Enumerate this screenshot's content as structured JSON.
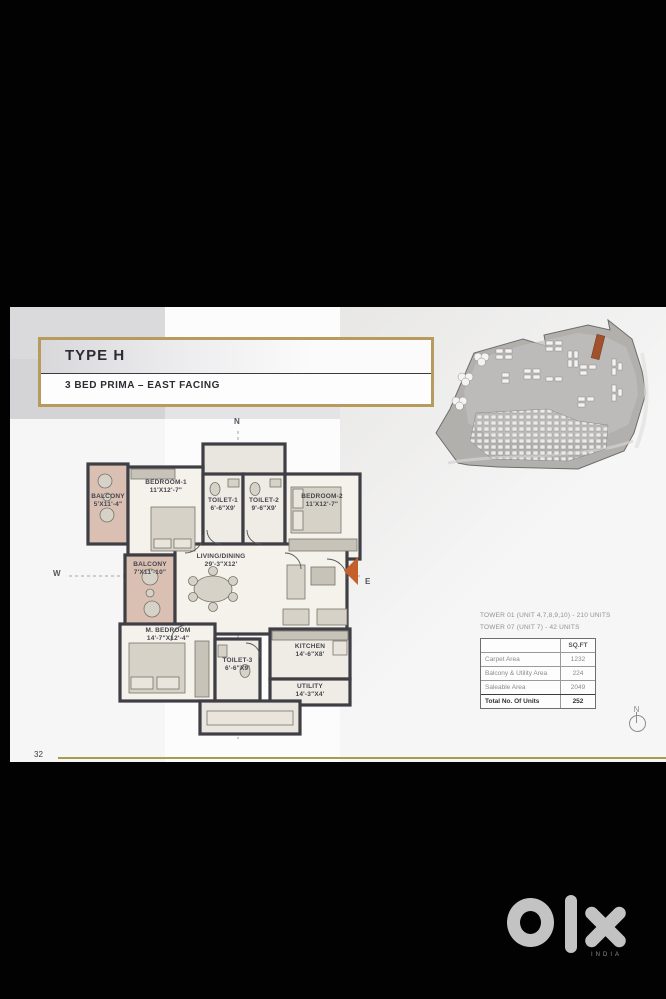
{
  "page": {
    "number": "32",
    "type_label": "TYPE H",
    "subtitle": "3 BED PRIMA – EAST FACING"
  },
  "keyplan": {
    "label": "KEYPLAN"
  },
  "compass": {
    "north": "N",
    "west": "W",
    "east": "E"
  },
  "floorplan": {
    "rooms": [
      {
        "name": "BALCONY",
        "dims": "5'X11'-4\""
      },
      {
        "name": "BEDROOM-1",
        "dims": "11'X12'-7\""
      },
      {
        "name": "TOILET-1",
        "dims": "6'-6\"X9'"
      },
      {
        "name": "TOILET-2",
        "dims": "9'-6\"X9'"
      },
      {
        "name": "BEDROOM-2",
        "dims": "11'X12'-7\""
      },
      {
        "name": "BALCONY",
        "dims": "7'X11'-10\""
      },
      {
        "name": "LIVING/DINING",
        "dims": "29'-3\"X12'"
      },
      {
        "name": "M. BEDROOM",
        "dims": "14'-7\"X12'-4\""
      },
      {
        "name": "TOILET-3",
        "dims": "6'-6\"X9'"
      },
      {
        "name": "KITCHEN",
        "dims": "14'-6\"X8'"
      },
      {
        "name": "UTILITY",
        "dims": "14'-3\"X4'"
      }
    ]
  },
  "tower_info": {
    "line1": "TOWER 01 (UNIT 4,7,8,9,10) - 210 UNITS",
    "line2": "TOWER 07 (UNIT 7) - 42 UNITS"
  },
  "area_table": {
    "unit_header": "SQ.FT",
    "rows": [
      {
        "label": "Carpet Area",
        "value": "1232"
      },
      {
        "label": "Balcony & Utility Area",
        "value": "224"
      },
      {
        "label": "Saleable Area",
        "value": "2049"
      }
    ],
    "total_row": {
      "label": "Total No. Of Units",
      "value": "252"
    }
  },
  "watermark": {
    "brand": "OLX",
    "country": "INDIA"
  },
  "colors": {
    "gold": "#b69a5e",
    "wall": "#3e3e44",
    "balcony_fill": "#d9c0b3",
    "entry_arrow": "#c4602a",
    "logo_gray": "#c3c3c3"
  }
}
